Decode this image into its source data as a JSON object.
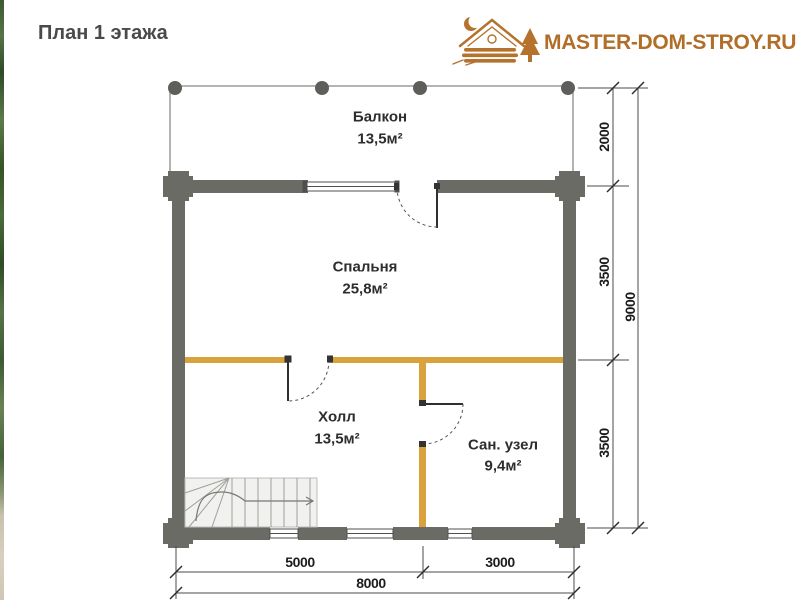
{
  "title": "План 1 этажа",
  "logo": {
    "text": "MASTER-DOM-STROY.RU",
    "icon": "log-cabin-moon-tree",
    "color": "#b5722c"
  },
  "rooms": {
    "balcony": {
      "name": "Балкон",
      "area": "13,5м²"
    },
    "bedroom": {
      "name": "Спальня",
      "area": "25,8м²"
    },
    "hall": {
      "name": "Холл",
      "area": "13,5м²"
    },
    "bathroom": {
      "name": "Сан. узел",
      "area": "9,4м²"
    }
  },
  "dimensions": {
    "right": {
      "balcony_depth": "2000",
      "bedroom_depth": "3500",
      "hall_depth": "3500",
      "total_depth": "9000"
    },
    "bottom": {
      "left_span": "5000",
      "right_span": "3000",
      "total_width": "8000"
    }
  },
  "colors": {
    "wall": "#6b6b65",
    "partition": "#d9a23c",
    "stairs_fill": "#f1f1ef",
    "logo": "#b5722c"
  }
}
